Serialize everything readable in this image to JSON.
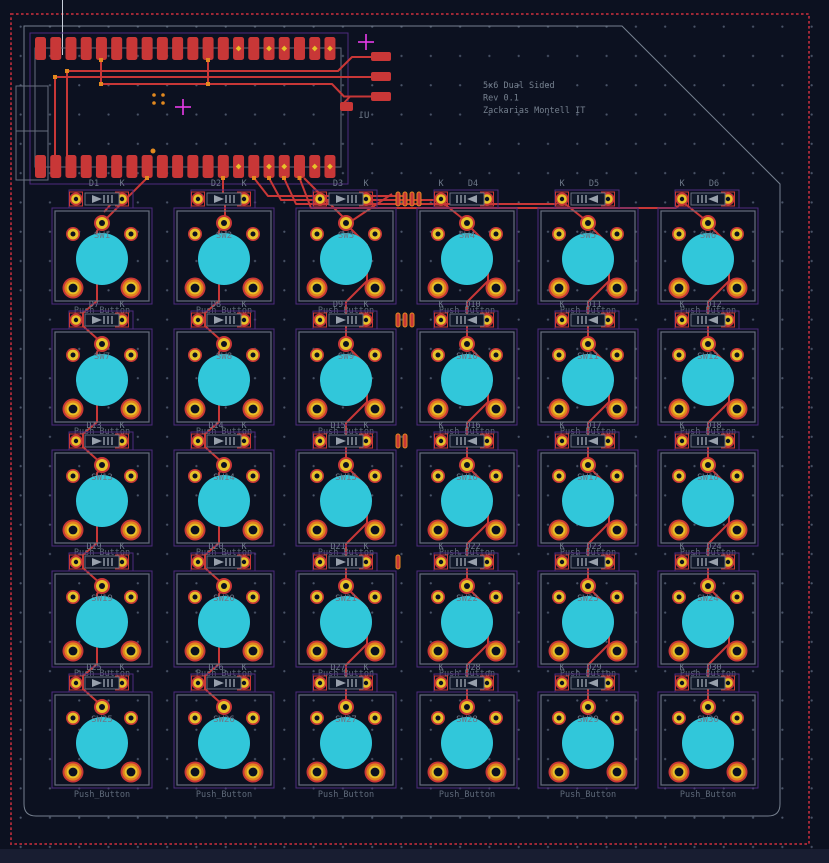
{
  "title_block": {
    "lines": [
      "5x6 Dual Sided",
      "Rev 0.1",
      "Zackarias Montell IT"
    ]
  },
  "header": {
    "reference": "U1",
    "pins_per_row": 20,
    "rows": 2
  },
  "labels": {
    "footprint": "Push_Button",
    "cathode": "K"
  },
  "switches": [
    "SW1",
    "SW2",
    "SW3",
    "SW4",
    "SW5",
    "SW6",
    "SW7",
    "SW8",
    "SW9",
    "SW10",
    "SW11",
    "SW12",
    "SW13",
    "SW14",
    "SW15",
    "SW16",
    "SW17",
    "SW18",
    "SW19",
    "SW20",
    "SW21",
    "SW22",
    "SW23",
    "SW24",
    "SW25",
    "SW26",
    "SW27",
    "SW28",
    "SW29",
    "SW30"
  ],
  "diodes": [
    "D1",
    "D2",
    "D3",
    "D4",
    "D5",
    "D6",
    "D7",
    "D8",
    "D9",
    "D10",
    "D11",
    "D12",
    "D13",
    "D14",
    "D15",
    "D16",
    "D17",
    "D18",
    "D19",
    "D20",
    "D21",
    "D22",
    "D23",
    "D24",
    "D25",
    "D26",
    "D27",
    "D28",
    "D29",
    "D30"
  ],
  "via_groups": [
    4,
    3,
    2,
    1,
    0
  ],
  "grid": {
    "columns": 6,
    "rows": 5
  },
  "colors": {
    "background": "#0c1120",
    "grid_dot": "#4a5468",
    "copper_back": "#c83737",
    "pad_yellow": "#e6c22a",
    "pad_orange": "#e2811f",
    "hole_dark": "#0c1120",
    "silk_cyan": "#31c7da",
    "courtyard_purple": "#4e2b7e",
    "fab_gray": "#666d7e",
    "text_gray": "#6d7888",
    "edge_gray": "#76808f",
    "zone_red": "#9e2836",
    "origin_magenta": "#e83be8",
    "junction_orange": "#e2891f",
    "diode_body_gray": "#98a0ac"
  }
}
